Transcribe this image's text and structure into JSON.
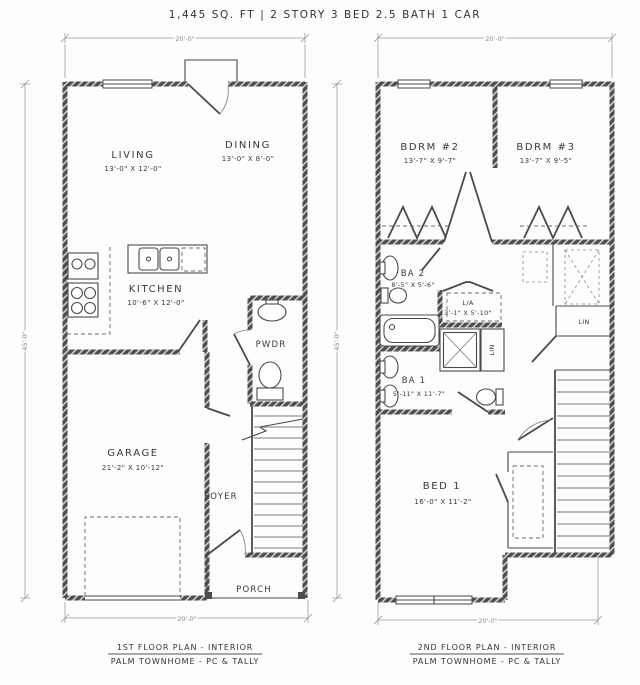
{
  "title": "1,445 SQ. FT | 2 STORY 3 BED 2.5 BATH 1 CAR",
  "first_floor": {
    "caption_line1": "1ST FLOOR PLAN - INTERIOR",
    "caption_line2": "PALM TOWNHOME - PC & TALLY",
    "dims": {
      "top": "20'-0\"",
      "side": "45'-0\"",
      "bottom": "20'-0\""
    },
    "rooms": {
      "living": {
        "name": "LIVING",
        "size": "13'-0\" X 12'-0\""
      },
      "dining": {
        "name": "DINING",
        "size": "13'-0\" X 8'-0\""
      },
      "kitchen": {
        "name": "KITCHEN",
        "size": "10'-6\" X 12'-0\""
      },
      "pwdr": {
        "name": "PWDR"
      },
      "garage": {
        "name": "GARAGE",
        "size": "21'-2\" X 10'-12\""
      },
      "foyer": {
        "name": "FOYER"
      },
      "porch": {
        "name": "PORCH"
      }
    }
  },
  "second_floor": {
    "caption_line1": "2ND FLOOR PLAN - INTERIOR",
    "caption_line2": "PALM TOWNHOME - PC & TALLY",
    "dims": {
      "top": "20'-0\"",
      "side": "45'-0\"",
      "bottom": "20'-0\""
    },
    "rooms": {
      "bdrm2": {
        "name": "BDRM #2",
        "size": "13'-7\" X 9'-7\""
      },
      "bdrm3": {
        "name": "BDRM #3",
        "size": "13'-7\" X 9'-5\""
      },
      "ba2": {
        "name": "BA 2",
        "size": "8'-5\" X 5'-6\""
      },
      "laundry": {
        "name": "L/A",
        "size": "3'-1\" X 5'-10\""
      },
      "lin_closet": {
        "name": "LIN"
      },
      "lin_hall": {
        "name": "LIN"
      },
      "ba1": {
        "name": "BA 1",
        "size": "5'-11\" X 11'-7\""
      },
      "bed1": {
        "name": "BED 1",
        "size": "16'-0\" X 11'-2\""
      }
    }
  },
  "colors": {
    "wall": "#4d4d4d",
    "line": "#4a4a4a",
    "dim": "#8a8a8a",
    "background": "#ffffff"
  }
}
